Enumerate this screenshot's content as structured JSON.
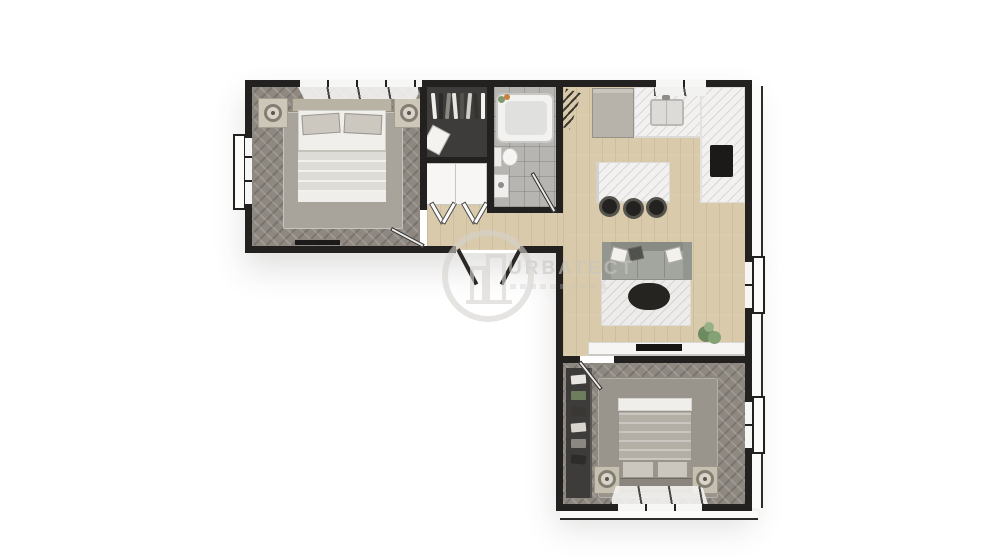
{
  "image_type": "3d-rendered-floor-plan",
  "watermark": {
    "brand": "URBATECT"
  },
  "colors": {
    "bg": "#ffffff",
    "wall": "#23211f",
    "wood": "#d8caaa",
    "herringbone": "#8e8881",
    "tile": "#b6b5b1",
    "closet": "#3e3c3a",
    "rug1": "#a9a49b",
    "rug2": "#9a958c",
    "marble": "#f2f1ef",
    "sofa": "#a2a69e",
    "dark_furniture": "#232220",
    "plant": "#78946a",
    "watermark": "#c9c6c1"
  },
  "rooms": [
    {
      "name": "bedroom-1",
      "furniture": [
        "double-bed",
        "nightstands",
        "table-lamps",
        "area-rug",
        "wall-tv"
      ]
    },
    {
      "name": "walk-in-closet",
      "furniture": [
        "clothes-rail",
        "storage-cabinet"
      ]
    },
    {
      "name": "bathroom",
      "furniture": [
        "bathtub",
        "toilet",
        "sink"
      ]
    },
    {
      "name": "kitchen",
      "furniture": [
        "fridge",
        "l-counter",
        "sink",
        "cooktop",
        "island",
        "bar-stools"
      ]
    },
    {
      "name": "living-room",
      "furniture": [
        "sofa",
        "coffee-table",
        "tv-console",
        "plant"
      ]
    },
    {
      "name": "bedroom-2",
      "furniture": [
        "double-bed",
        "nightstands",
        "table-lamps",
        "area-rug",
        "open-closet"
      ]
    }
  ],
  "closet_clothes_colors": [
    "#f0efec",
    "#2e2c2a",
    "#8b8781",
    "#e8e6e2",
    "#55524e",
    "#cfccc6",
    "#35332f",
    "#f4f3f0"
  ],
  "closet2_clothes_colors": [
    "#e8e6e2",
    "#6f7d5f",
    "#3a3835",
    "#d8d5cf",
    "#8b8781",
    "#2e2c2a"
  ]
}
